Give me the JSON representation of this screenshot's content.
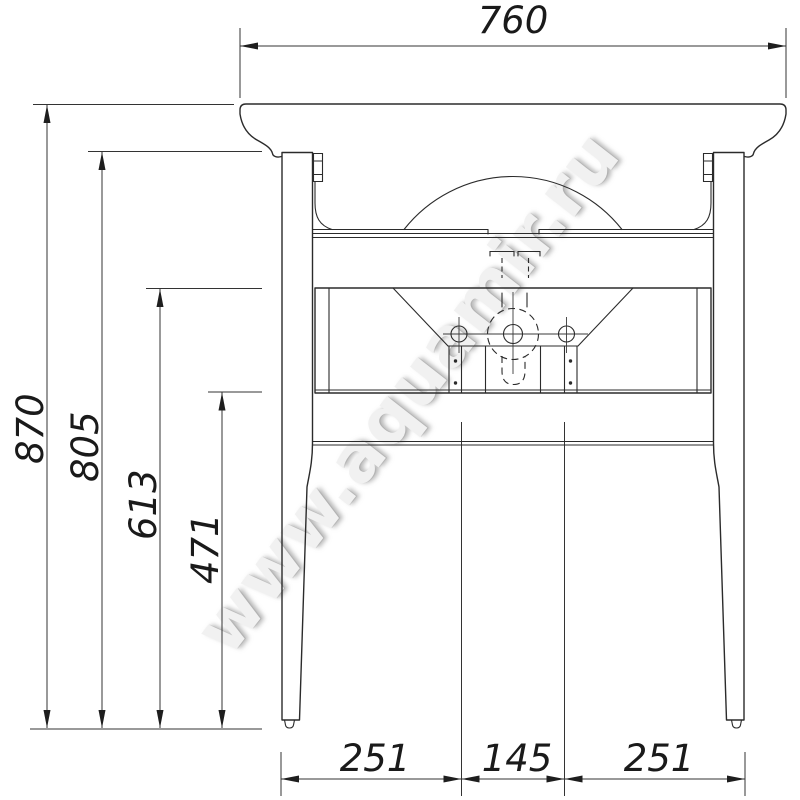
{
  "watermark": {
    "text": "www.aquamir.ru"
  },
  "dimensions": {
    "overall_width_mm": "760",
    "overall_height_mm": "870",
    "leg_top_height_mm": "805",
    "frame_top_height_mm": "613",
    "frame_bottom_height_mm": "471",
    "bottom_left_span_mm": "251",
    "bottom_center_span_mm": "145",
    "bottom_right_span_mm": "251"
  }
}
